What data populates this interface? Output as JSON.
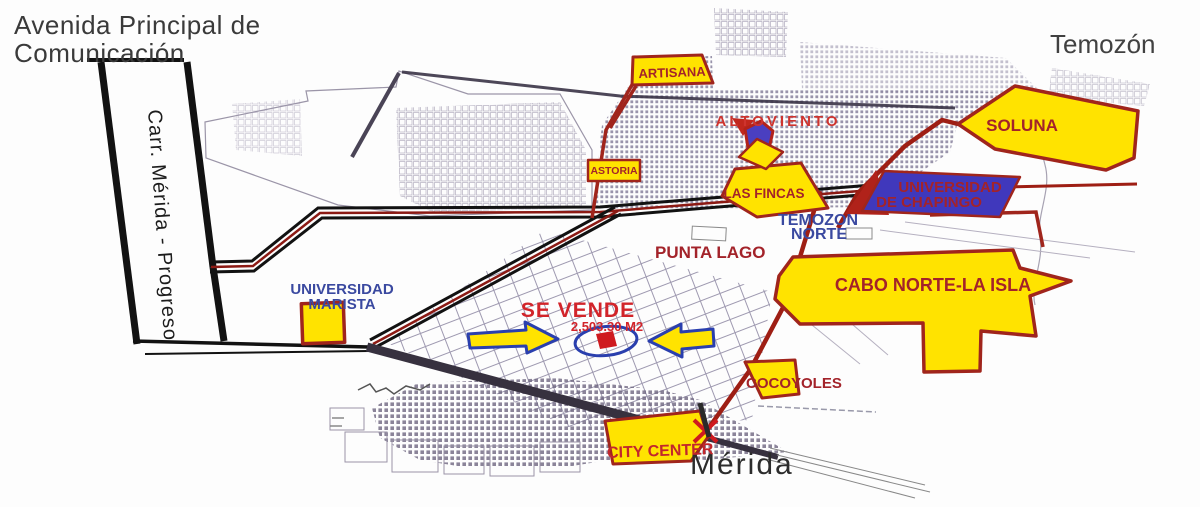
{
  "canvas": {
    "width": 1200,
    "height": 507
  },
  "corner_labels": {
    "avenida_line1": "Avenida Principal de",
    "avenida_line2": "Comunicación",
    "temozon": "Temozón",
    "merida": "Mérida",
    "carretera": "Carr. Mérida - Progreso"
  },
  "district_labels": {
    "temozon_norte_line1": "TEMOZON",
    "temozon_norte_line2": "NORTE",
    "punta_lago": "PUNTA LAGO",
    "universidad_marista_line1": "UNIVERSIDAD",
    "universidad_marista_line2": "MARISTA",
    "altoviento": "ALTOVIENTO"
  },
  "areas": {
    "artisana": "ARTISANA",
    "astoria": "ASTORIA",
    "las_fincas": "LAS FINCAS",
    "soluna": "SOLUNA",
    "chapingo_line1": "UNIVERSIDAD",
    "chapingo_line2": "DE CHAPINGO",
    "cabo_norte_la_isla": "CABO NORTE-LA ISLA",
    "cocoyoles": "COCOYOLES",
    "city_center": "CITY CENTER"
  },
  "listing": {
    "title": "SE VENDE",
    "area": "2,503.30 M2"
  },
  "colors": {
    "highlight_yellow": "#ffe300",
    "area_border_red": "#a0251c",
    "label_dark_red": "#a3232a",
    "label_bright_red": "#d2242a",
    "label_blue": "#3a49a0",
    "university_blue": "#4038bc",
    "road_red": "#9e1e14",
    "arrow_outline_blue": "#2a3fae"
  }
}
